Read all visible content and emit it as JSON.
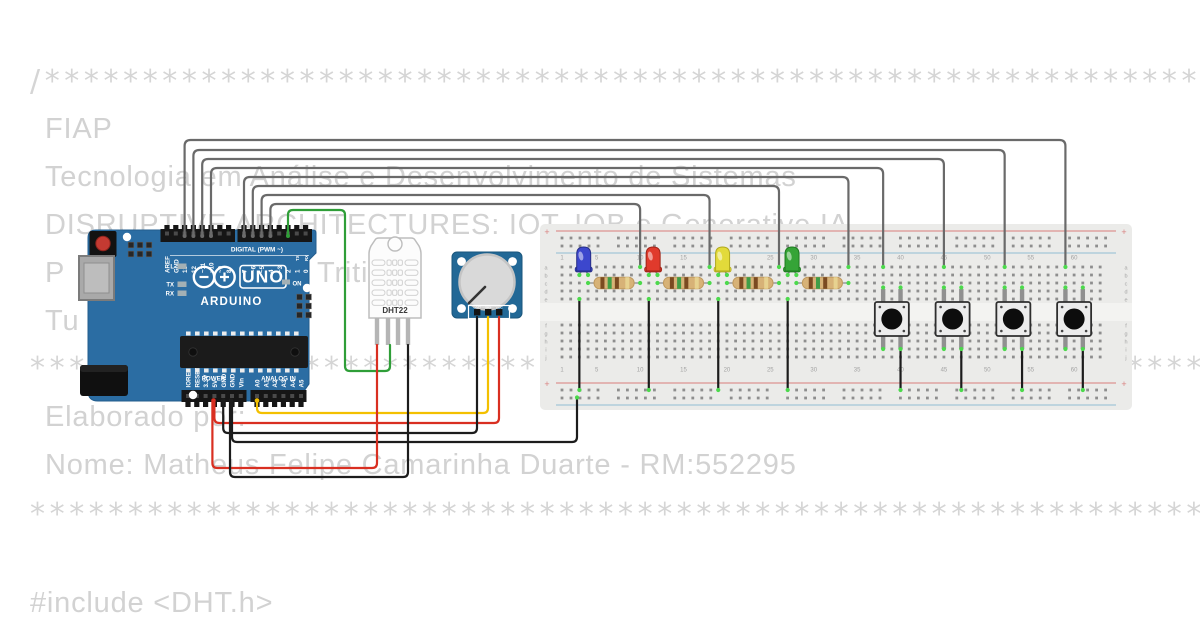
{
  "comments": {
    "divider_open": "/*******************************************************************",
    "org": "FIAP",
    "course": "Tecnologia em Análise e Desenvolvimento de Sistemas",
    "discipline": "DISRUPTIVE ARCHITECTURES: IOT, IOB e Generative IA",
    "line4_fragment_left": "P",
    "line4_fragment_right": "Triti",
    "line5_fragment": "Tu",
    "divider_mid": "********************************************************************",
    "credits_label": "Elaborado por:",
    "author": "Nome: Matheus Felipe Camarinha Duarte - RM:552295",
    "divider_close": "********************************************************************",
    "code_line": "#include <DHT.h>"
  },
  "arduino": {
    "digital_header": [
      "AREF",
      "GND",
      "13",
      "12",
      "~11",
      "~10",
      "~9",
      "8",
      "7",
      "~6",
      "~5",
      "4",
      "~3",
      "2",
      "1",
      "0"
    ],
    "pin1_tx": "TX",
    "pin0_rx": "RX",
    "digital_caption": "DIGITAL (PWM ~)",
    "logo_text": "UNO",
    "brand": "ARDUINO",
    "on_label": "ON",
    "led_l": "L",
    "led_tx": "TX",
    "led_rx": "RX",
    "power_header": [
      "IOREF",
      "RESET",
      "3.3V",
      "5V",
      "GND",
      "GND",
      "Vin"
    ],
    "power_caption": "POWER",
    "analog_header": [
      "A0",
      "A1",
      "A2",
      "A3",
      "A4",
      "A5"
    ],
    "analog_caption": "ANALOG IN"
  },
  "dht22": {
    "label": "DHT22"
  },
  "pot": {
    "pin_labels": [
      "GND",
      "SIG",
      "VCC"
    ]
  },
  "breadboard": {
    "plus_sign": "+",
    "column_numbers": [
      "1",
      "5",
      "10",
      "15",
      "20",
      "25",
      "30",
      "35",
      "40",
      "45",
      "50",
      "55",
      "60"
    ],
    "rows_top": [
      "a",
      "b",
      "c",
      "d",
      "e"
    ],
    "rows_bottom": [
      "f",
      "g",
      "h",
      "i",
      "j"
    ]
  },
  "colors": {
    "text_gray": "#d2d2d2",
    "board_blue": "#2b6da3",
    "pot_blue": "#226896",
    "breadboard_body": "#ebebe9",
    "wire_gray": "#6a6a6a",
    "wire_green": "#2f9e38",
    "wire_red": "#d92f21",
    "wire_black": "#1c1c1c",
    "wire_yellow": "#f3c000",
    "dot_green": "#4cd94c",
    "led_blue": "#3c47cd",
    "led_red": "#e03a2c",
    "led_yellow": "#e2da3a",
    "led_green": "#35a437",
    "resistor_body": "#d7b277"
  }
}
